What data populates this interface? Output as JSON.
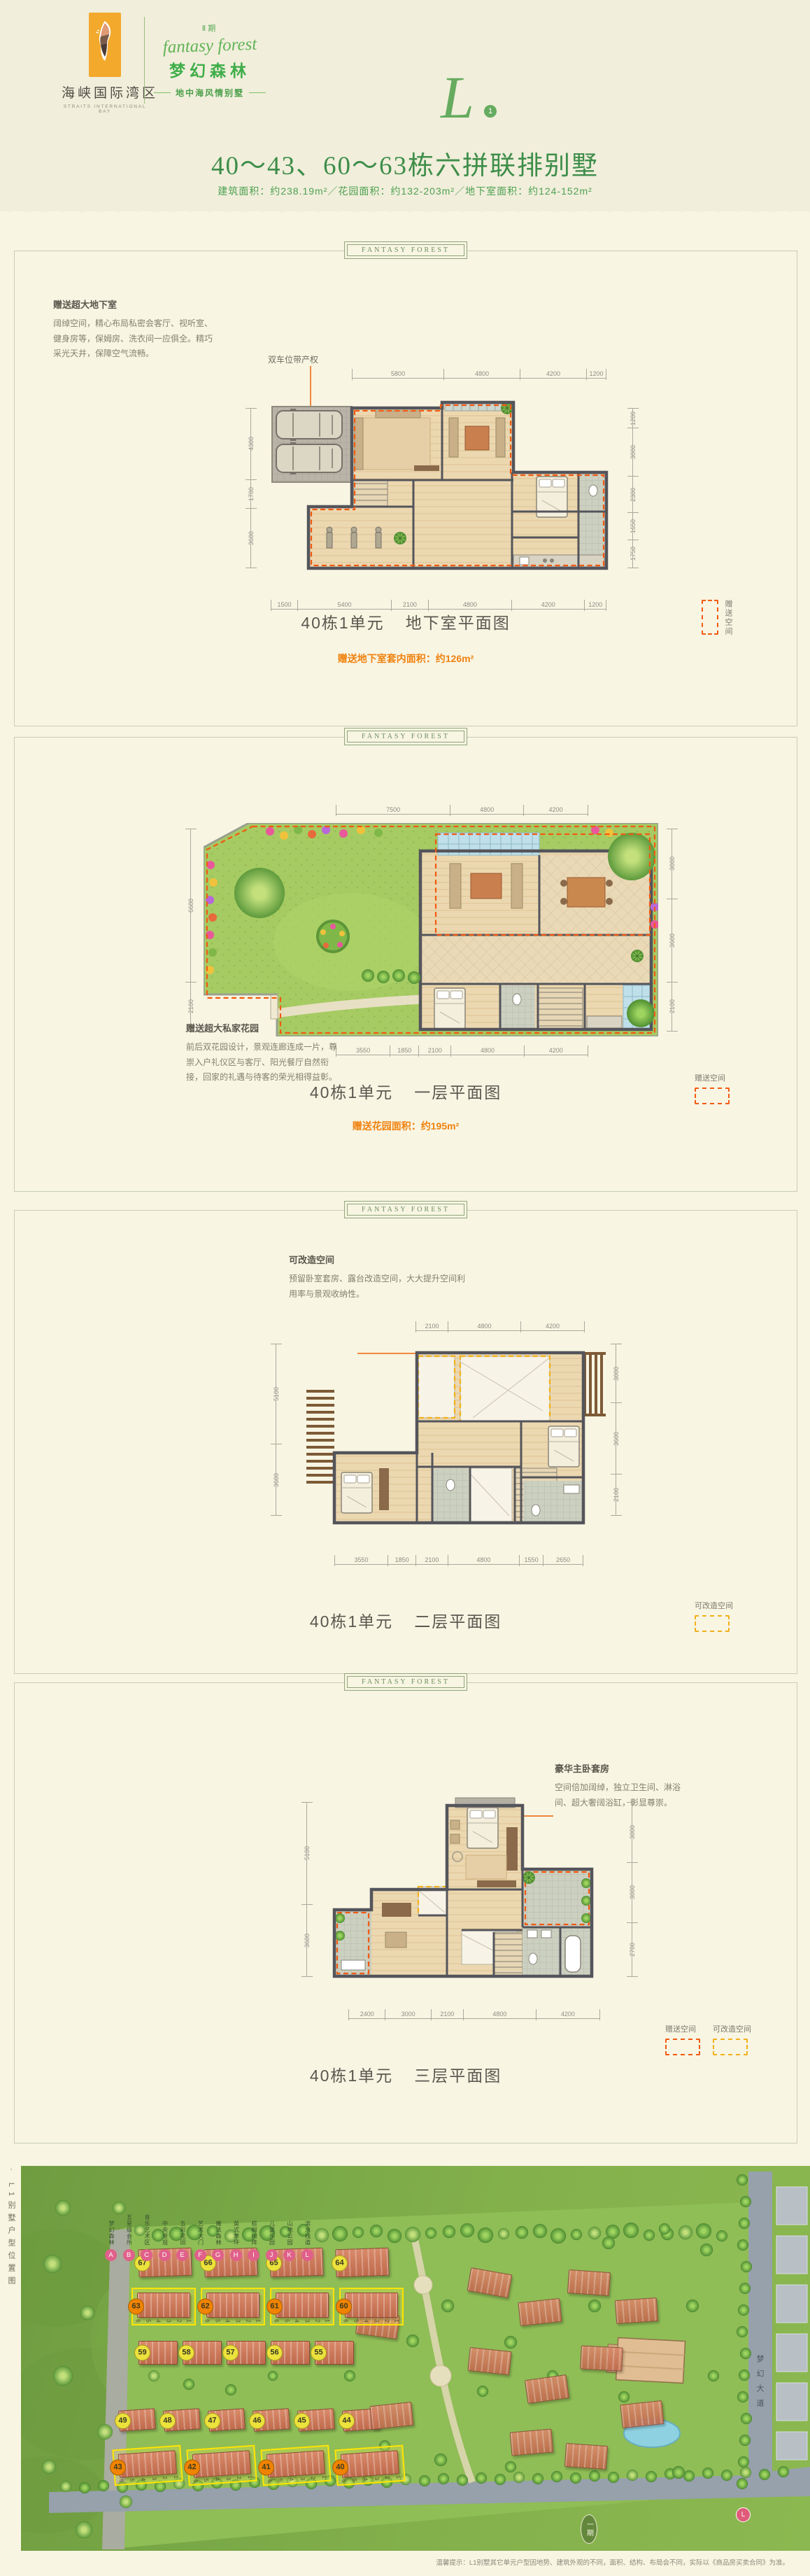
{
  "header": {
    "brand_cn": "海峡国际湾区",
    "brand_en": "STRAITS INTERNATIONAL BAY",
    "phase": "Ⅱ期",
    "script": "fantasy forest",
    "project_cn": "梦幻森林",
    "tagline": "地中海风情别墅"
  },
  "emblem": {
    "letter": "L",
    "index": "1"
  },
  "hero": {
    "title": "40～43、60～63栋六拼联排别墅",
    "subtitle": "建筑面积：约238.19m²／花园面积：约132-203m²／地下室面积：约124-152m²"
  },
  "panel_badge": "FANTASY FOREST",
  "legend_labels": {
    "gift": "赠送空间",
    "convert": "可改造空间"
  },
  "panels": [
    {
      "unit": "40栋1单元",
      "floor": "地下室平面图",
      "area_note": "赠送地下室套内面积：约126m²",
      "annotation": {
        "title": "赠送超大地下室",
        "body": "阔绰空间，精心布局私密会客厅、视听室、健身房等，保姆房、洗衣间一应俱全。精巧采光天井，保障空气流畅。"
      },
      "callout": "双车位带产权",
      "dims": {
        "top": [
          "5800",
          "4800",
          "4200",
          "1200"
        ],
        "right": [
          "1200",
          "3000",
          "2300",
          "1650",
          "1750"
        ],
        "bottom": [
          "1500",
          "5400",
          "2100",
          "4800",
          "4200",
          "1200"
        ],
        "left": [
          "4300",
          "1700",
          "3600"
        ]
      }
    },
    {
      "unit": "40栋1单元",
      "floor": "一层平面图",
      "area_note": "赠送花园面积：约195m²",
      "annotation": {
        "title": "赠送超大私家花园",
        "body": "前后双花园设计，景观连廊连成一片，尊崇入户礼仪区与客厅、阳光餐厅自然衔接，回家的礼遇与待客的荣光相得益彰。"
      },
      "dims": {
        "top": [
          "7500",
          "4800",
          "4200"
        ],
        "right": [
          "3000",
          "3600",
          "2100"
        ],
        "bottom": [
          "3550",
          "1850",
          "2100",
          "4800",
          "4200"
        ],
        "left": [
          "6600",
          "2100"
        ]
      }
    },
    {
      "unit": "40栋1单元",
      "floor": "二层平面图",
      "annotation": {
        "title": "可改造空间",
        "body": "预留卧室套房、露台改造空间，大大提升空间利用率与景观收纳性。"
      },
      "dims": {
        "top": [
          "2100",
          "4800",
          "4200"
        ],
        "right": [
          "3000",
          "3600",
          "2100"
        ],
        "bottom": [
          "3550",
          "1850",
          "2100",
          "4800",
          "1550",
          "2650"
        ],
        "left": [
          "5100",
          "3600"
        ]
      }
    },
    {
      "unit": "40栋1单元",
      "floor": "三层平面图",
      "annotation": {
        "title": "豪华主卧套房",
        "body": "空间倍加阔绰，独立卫生间、淋浴间、超大奢阔浴缸，彰显尊崇。"
      },
      "dims": {
        "right": [
          "3000",
          "3000",
          "2700"
        ],
        "bottom": [
          "2400",
          "3000",
          "2100",
          "4800",
          "4200"
        ],
        "left": [
          "5100",
          "3600"
        ]
      }
    }
  ],
  "sitemap": {
    "side_caption": "· L1别墅户型位置图",
    "legend": [
      {
        "key": "A",
        "label": "梦幻森林"
      },
      {
        "key": "B",
        "label": "五星级会所"
      },
      {
        "key": "C",
        "label": "音乐艺术区"
      },
      {
        "key": "D",
        "label": "中央景观"
      },
      {
        "key": "E",
        "label": "五彩花田"
      },
      {
        "key": "F",
        "label": "艺术大门"
      },
      {
        "key": "G",
        "label": "魔法森林"
      },
      {
        "key": "H",
        "label": "英式草坪"
      },
      {
        "key": "I",
        "label": "棕榈树阵"
      },
      {
        "key": "J",
        "label": "儿童乐园"
      },
      {
        "key": "K",
        "label": "山地公园"
      },
      {
        "key": "L",
        "label": "滨水栈道"
      }
    ],
    "building_rows": [
      {
        "nums": [
          "67",
          "66",
          "65",
          "64"
        ],
        "highlight": false
      },
      {
        "nums": [
          "63",
          "62",
          "61",
          "60"
        ],
        "highlight": true,
        "units": [
          "6",
          "5",
          "4",
          "3",
          "2",
          "1"
        ]
      },
      {
        "nums": [
          "59",
          "58",
          "57",
          "56",
          "55"
        ],
        "highlight": false
      },
      {
        "nums": [
          "49",
          "48",
          "47",
          "46",
          "45",
          "44"
        ],
        "highlight": false
      },
      {
        "nums": [
          "43",
          "42",
          "41",
          "40"
        ],
        "highlight": true,
        "units": [
          "6",
          "5",
          "4",
          "3",
          "2",
          "1"
        ]
      }
    ],
    "phase_label": "一期",
    "road_label": "梦幻大道",
    "map_marker": "L",
    "disclaimer": "温馨提示：L1别墅其它单元户型因地势、建筑外观的不同，面积、结构、布局会不同，实际以《商品房买卖合同》为准。"
  },
  "colors": {
    "accent_green": "#3fae49",
    "title_green": "#3e8e4a",
    "orange": "#f0820f",
    "dash_orange": "#f25a12",
    "dash_yellow": "#f2b01c",
    "cream_top": "#f1eedb",
    "cream_main": "#f8f5e3",
    "wall_gray": "#54555b",
    "legend_pink": "#e0608a"
  }
}
